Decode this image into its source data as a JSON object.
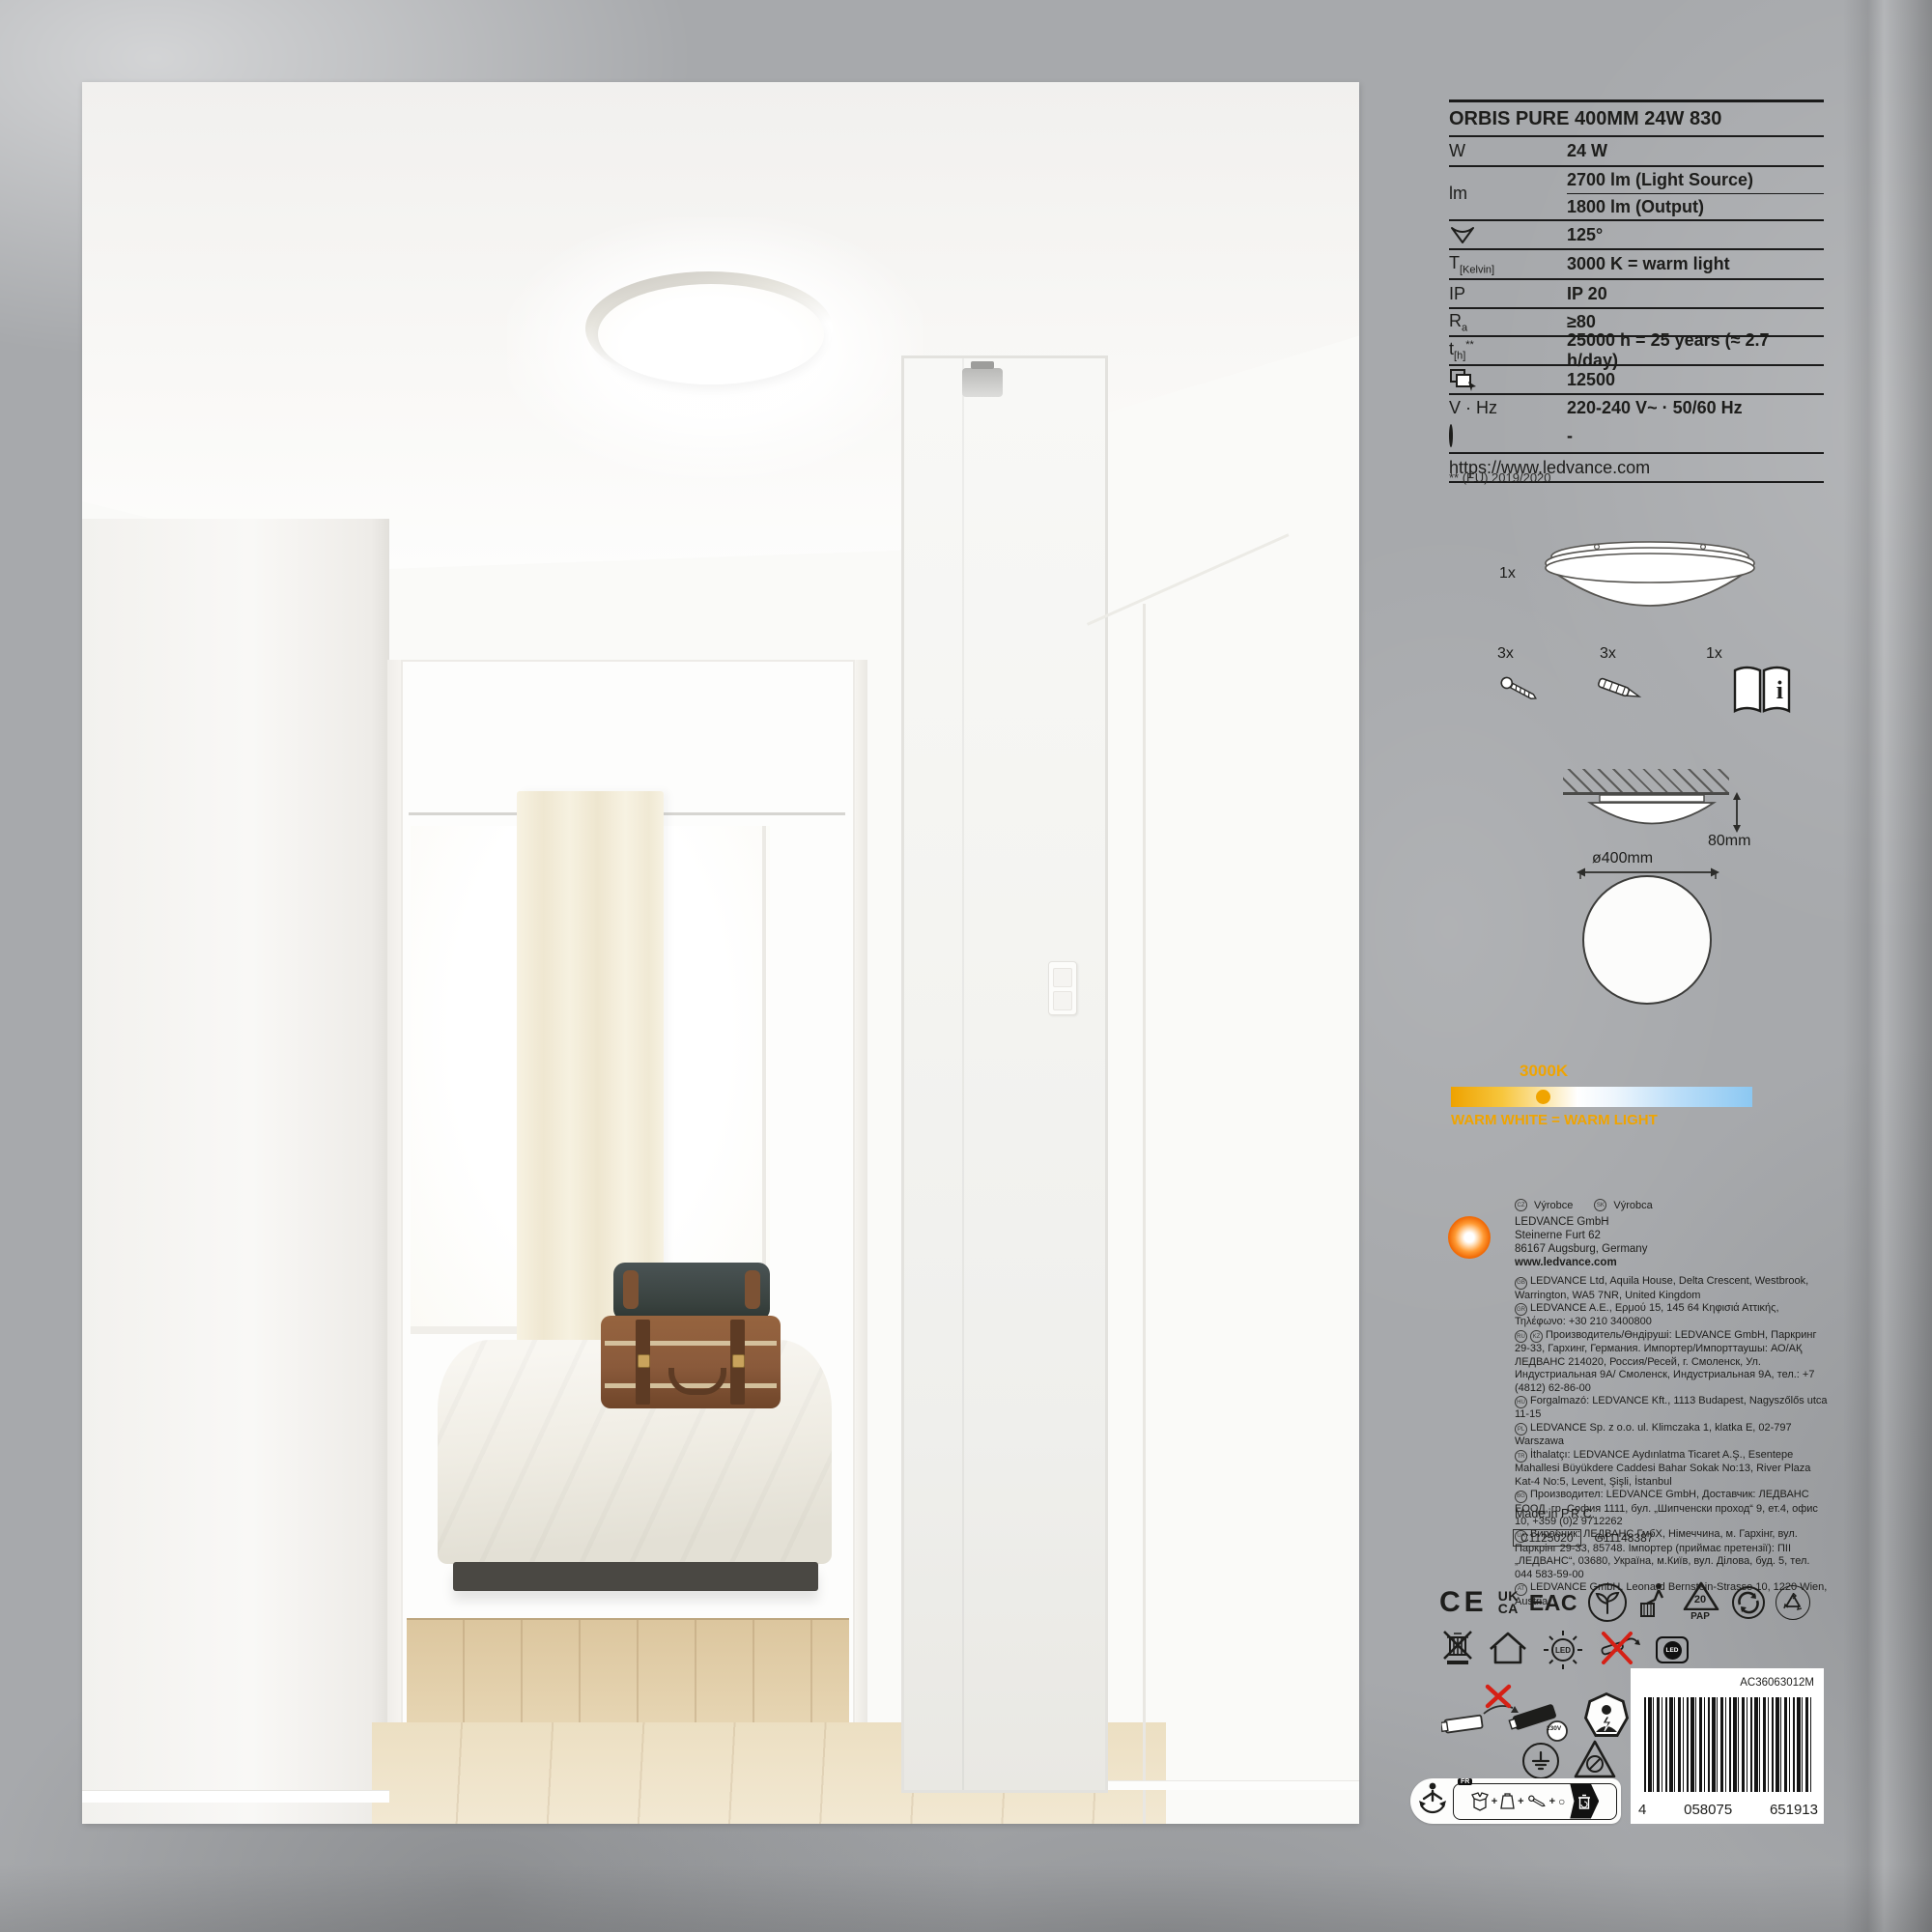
{
  "spec": {
    "title": "ORBIS PURE 400MM 24W 830",
    "rows": [
      {
        "label": "W",
        "value": "24 W"
      },
      {
        "label": "lm",
        "value_a": "2700 lm (Light Source)",
        "value_b": "1800 lm (Output)"
      },
      {
        "value": "125°"
      },
      {
        "base": "T",
        "sub": "[Kelvin]",
        "value": "3000 K = warm light"
      },
      {
        "label": "IP",
        "value": "IP 20"
      },
      {
        "base": "R",
        "sub": "a",
        "value": "≥80"
      },
      {
        "base": "t",
        "sub": "[h]",
        "sup": "**",
        "value": "25000 h = 25 years (≈ 2.7 h/day)"
      },
      {
        "value": "12500"
      },
      {
        "label": "V · Hz",
        "value": "220-240 V~ · 50/60 Hz"
      },
      {
        "value": "-"
      }
    ],
    "url": "https://www.ledvance.com",
    "footnote": "** (EU) 2019/2020"
  },
  "contents": {
    "luminaire_qty": "1x",
    "screws_qty": "3x",
    "anchors_qty": "3x",
    "manual_qty": "1x",
    "manual_i": "i"
  },
  "mounting": {
    "height": "80mm",
    "diameter": "ø400mm"
  },
  "cct": {
    "temp": "3000K",
    "caption": "WARM WHITE = WARM LIGHT",
    "accent_color": "#f0a400"
  },
  "producer": {
    "cz_cc": "CZ",
    "cz_label": "Výrobce",
    "sk_cc": "SK",
    "sk_label": "Výrobca"
  },
  "company": {
    "name": "LEDVANCE GmbH",
    "street": "Steinerne Furt 62",
    "city": "86167 Augsburg, Germany",
    "website": "www.ledvance.com"
  },
  "addresses": [
    {
      "cc": "GB",
      "text": "LEDVANCE Ltd, Aquila House, Delta Crescent, Westbrook, Warrington, WA5 7NR, United Kingdom"
    },
    {
      "cc": "GR",
      "text": "LEDVANCE A.E., Ερμού 15, 145 64 Κηφισιά Αττικής, Τηλέφωνο: +30 210 3400800"
    },
    {
      "cc": "RU",
      "cc2": "KZ",
      "text": "Производитель/Өндіруші: LEDVANCE GmbH, Паркринг 29-33, Гархинг, Германия. Импортер/Импорттаушы: АО/АҚ ЛЕДВАНС 214020, Россия/Ресей, г. Смоленск, Ул. Индустриальная 9А/ Смоленск, Индустриальная 9А, тел.: +7 (4812) 62-86-00"
    },
    {
      "cc": "HU",
      "text": "Forgalmazó: LEDVANCE Kft., 1113 Budapest, Nagyszőlős utca 11-15"
    },
    {
      "cc": "PL",
      "text": "LEDVANCE Sp. z o.o. ul. Klimczaka 1, klatka E, 02-797 Warszawa"
    },
    {
      "cc": "TR",
      "text": "İthalatçı: LEDVANCE Aydınlatma Ticaret A.Ş., Esentepe Mahallesi Büyükdere Caddesi Bahar Sokak No:13, River Plaza Kat-4 No:5, Levent, Şişli, İstanbul"
    },
    {
      "cc": "BG",
      "text": "Производител: LEDVANCE GmbH, Доставчик: ЛЕДВАНС ЕООД, гр. София 1111, бул. „Шипченски проход“ 9, ет.4, офис 10, +359 (0)2 9712262"
    },
    {
      "cc": "UA",
      "text": "Виробник: ЛЕДВАНС ГмбХ, Німеччина, м. Гархінг, вул. Паркрінг 29-33, 85748. Імпортер (приймає претензії): ПІІ „ЛЕДВАНС“, 03680, Україна, м.Київ, вул. Ділова, буд. 5, тел. 044 583-59-00"
    },
    {
      "cc": "AT",
      "text": "LEDVANCE GmbH, Leonard Bernstein-Strasse 10, 1220 Wien, Austria"
    }
  ],
  "made_in": "Made in P.R.C.",
  "codes": {
    "config": "C1125020",
    "global": "G11148387"
  },
  "marks": {
    "ce": "CE",
    "uk": "UK",
    "ca": "CA",
    "eac": "EAC",
    "pap_num": "20",
    "pap": "PAP",
    "led_sun": "LED",
    "led_badge": "LED",
    "driver_volt": "230V",
    "fr": "FR",
    "plus": "+",
    "circle": "○"
  },
  "barcode": {
    "sku": "AC36063012M",
    "ean_1": "4",
    "ean_2": "058075",
    "ean_3": "651913"
  }
}
